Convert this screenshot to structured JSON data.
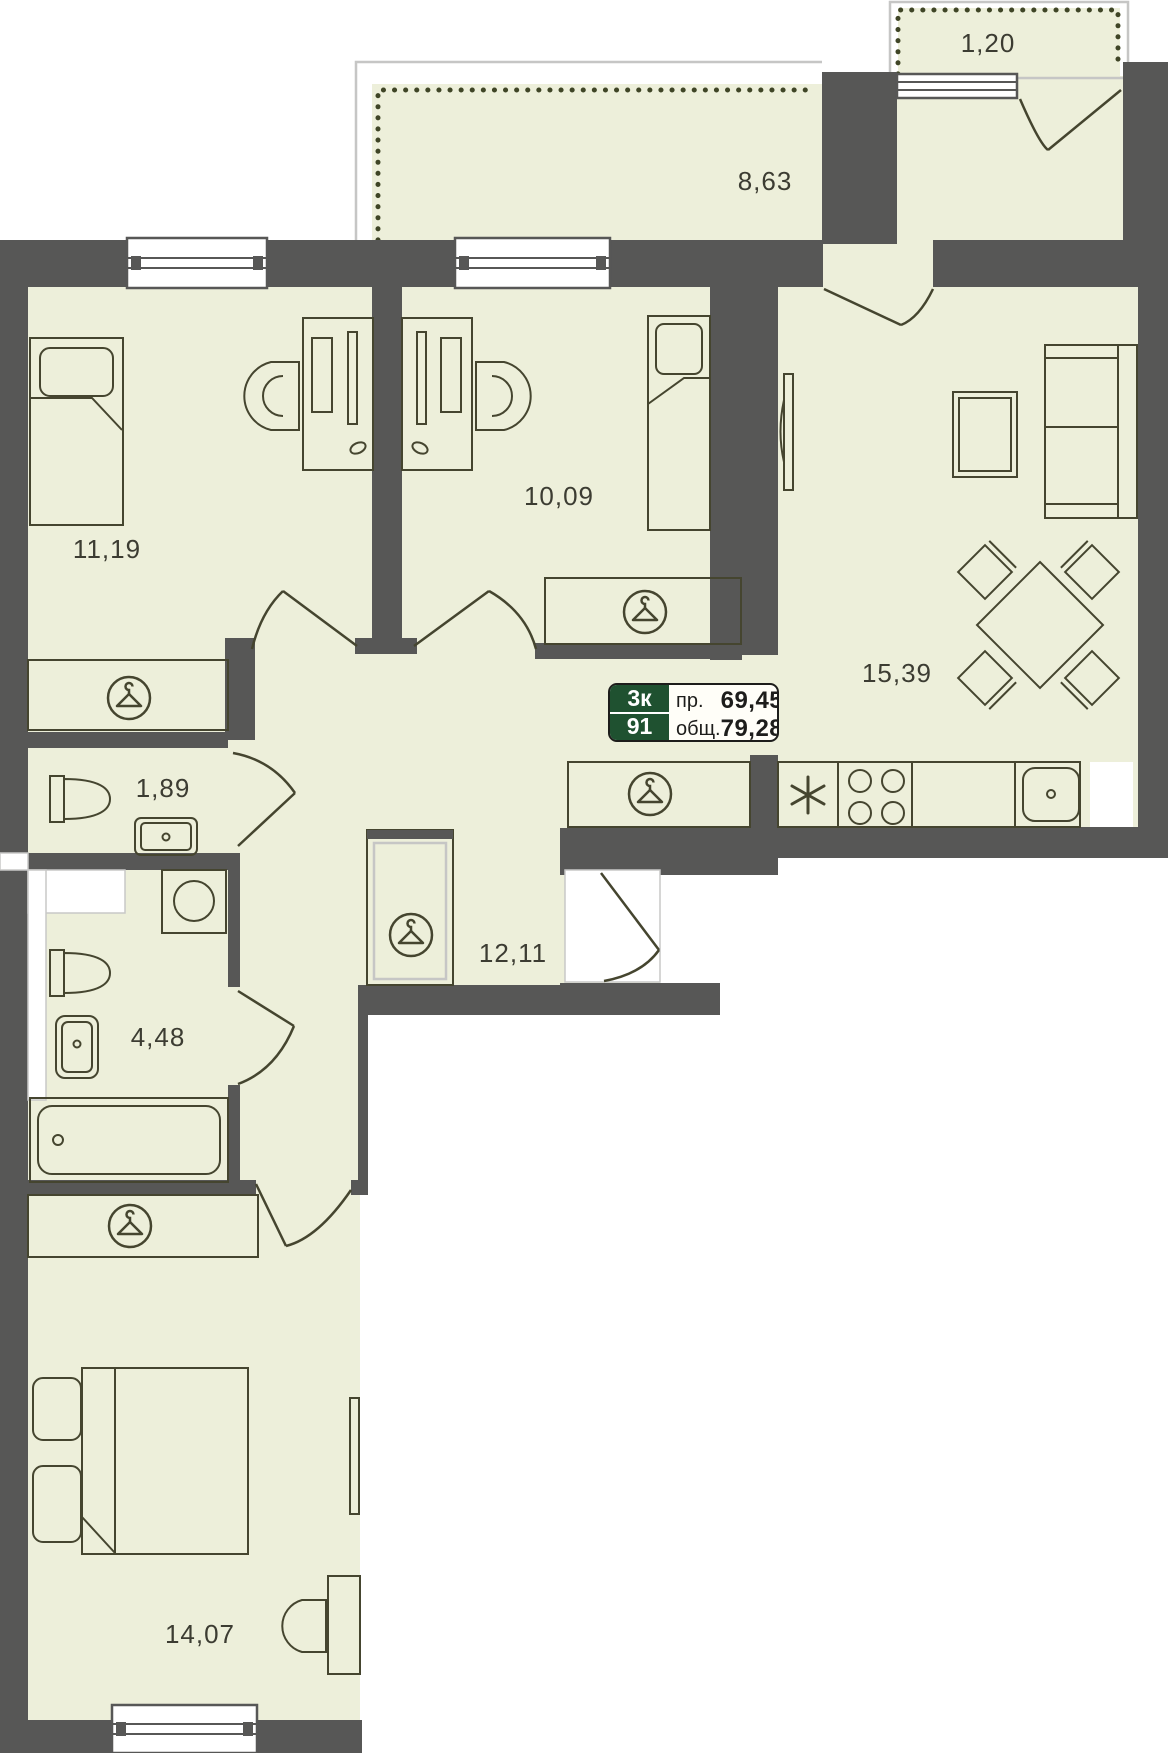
{
  "badge": {
    "rooms": "3к",
    "unit": "91",
    "living_label": "пр.",
    "living_value": "69,45",
    "total_label": "общ.",
    "total_value": "79,28"
  },
  "areas": {
    "balcony_small": "1,20",
    "balcony_large": "8,63",
    "bedroom_1": "11,19",
    "bedroom_2": "10,09",
    "living_kitchen": "15,39",
    "toilet": "1,89",
    "bathroom": "4,48",
    "hallway": "12,11",
    "bedroom_3": "14,07"
  },
  "colors": {
    "floor": "#edefda",
    "wall": "#575756",
    "furniture_outline": "#45452f",
    "accent_green": "#1f5130",
    "label_text": "#3c3c32"
  }
}
